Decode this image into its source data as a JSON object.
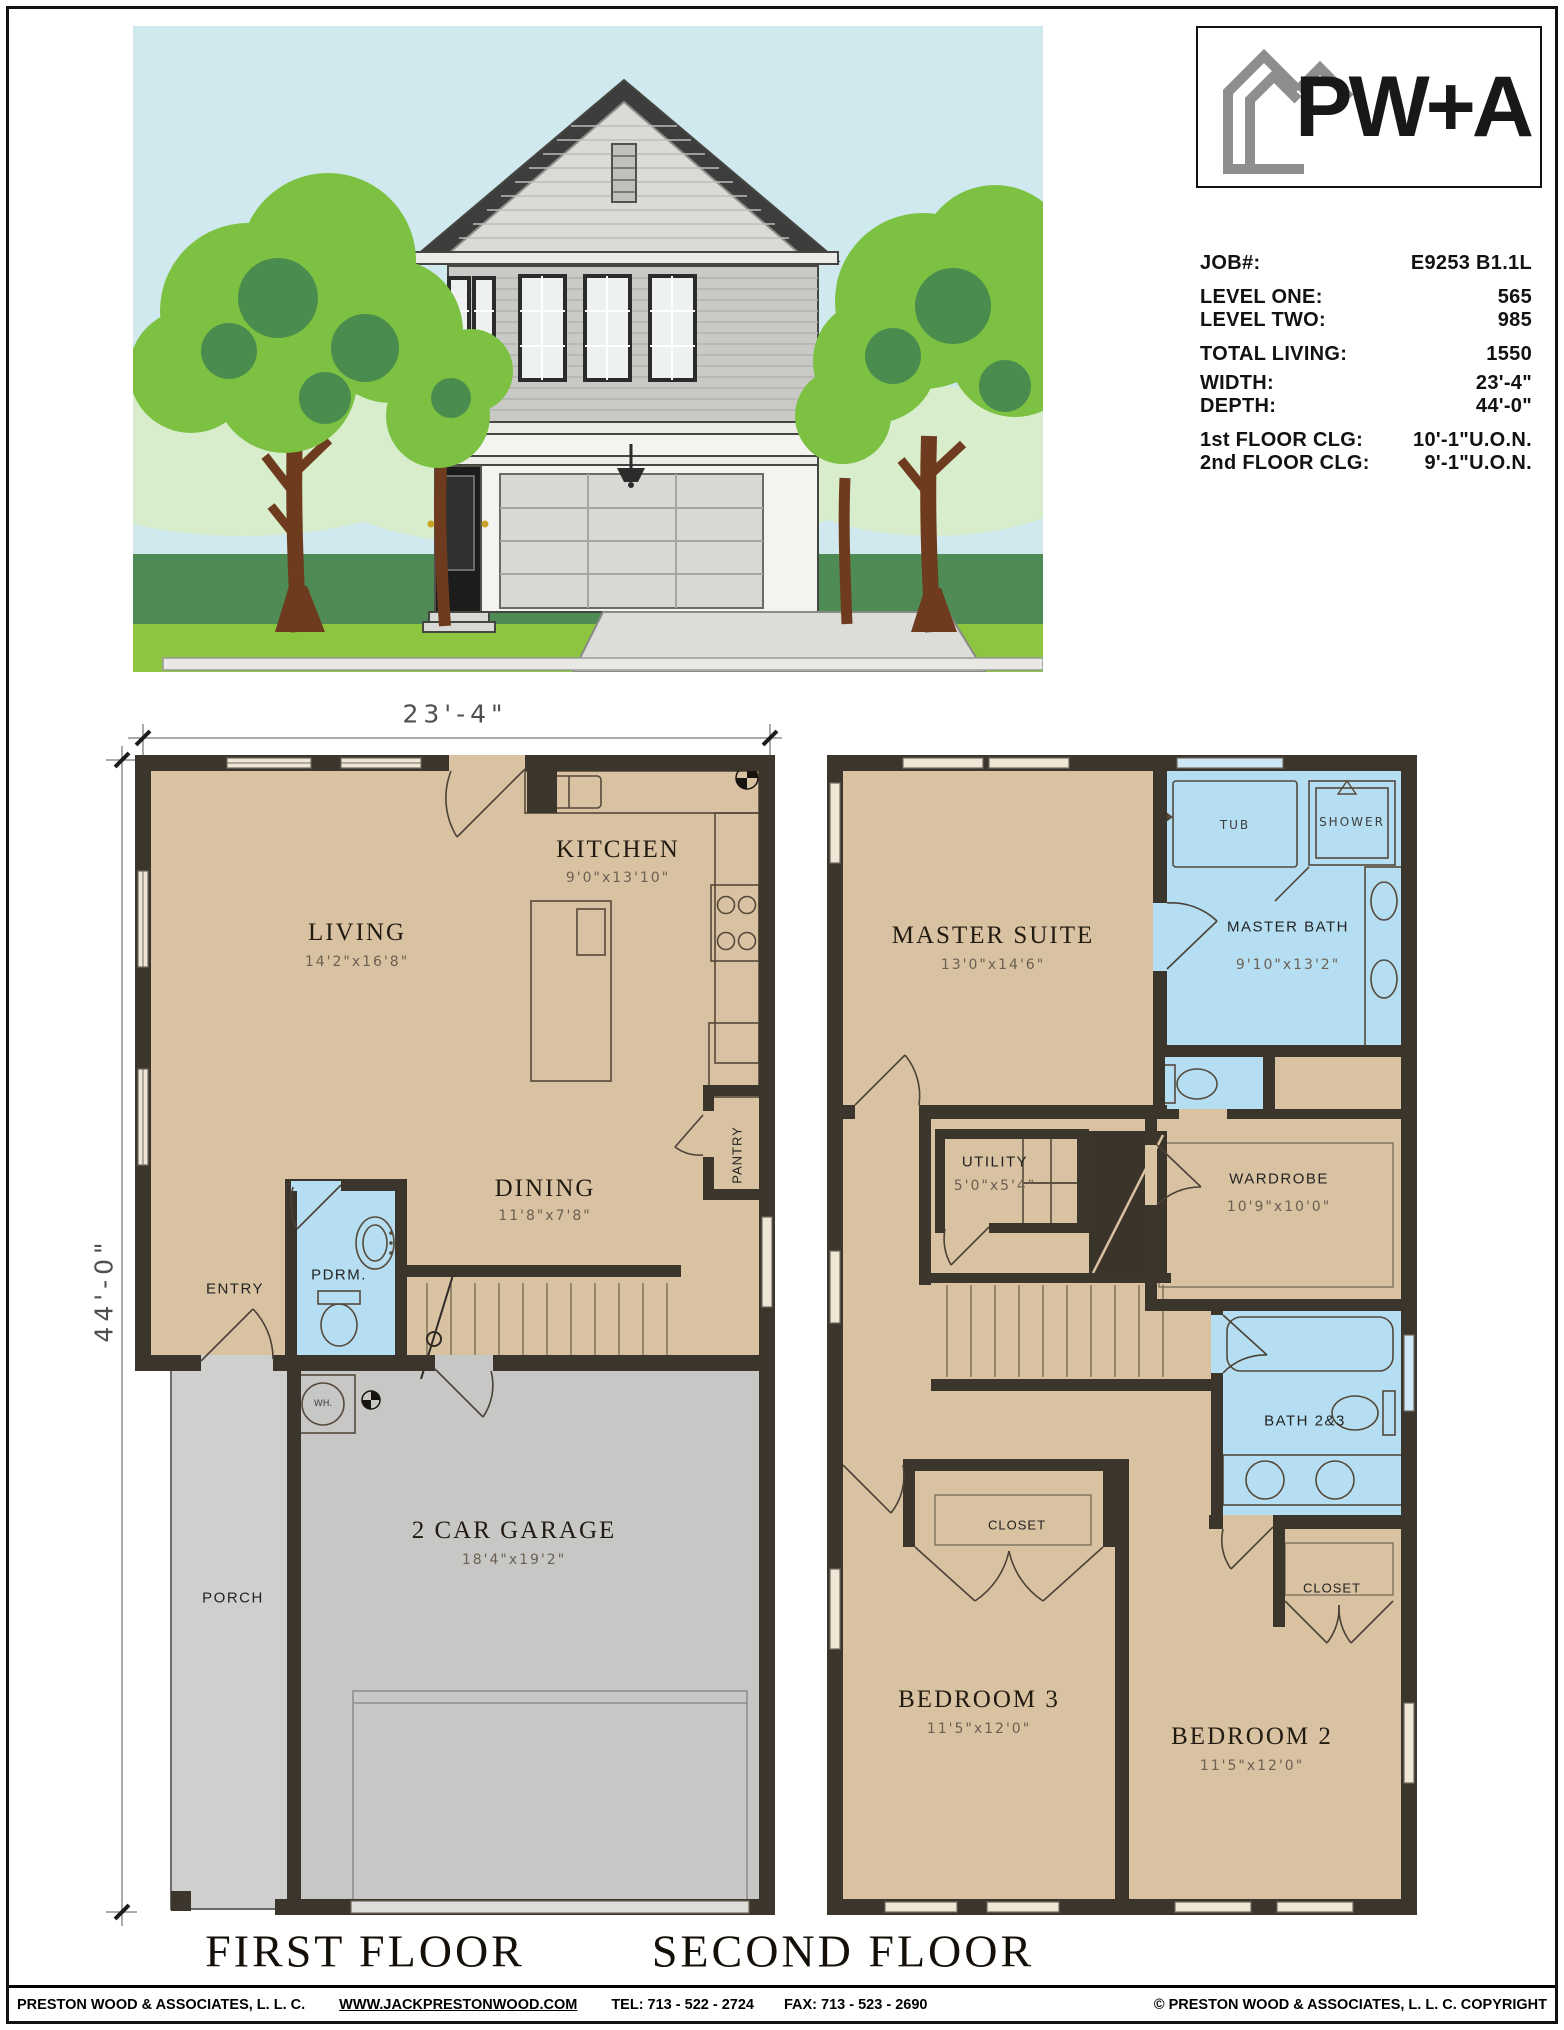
{
  "logo": {
    "text": "PW+A"
  },
  "job": {
    "rows": [
      {
        "label": "JOB#:",
        "value": "E9253 B1.1L"
      },
      {
        "label": "LEVEL ONE:",
        "value": "565"
      },
      {
        "label": "LEVEL TWO:",
        "value": "985"
      },
      {
        "label": "TOTAL LIVING:",
        "value": "1550"
      },
      {
        "label": "WIDTH:",
        "value": "23'-4\""
      },
      {
        "label": "DEPTH:",
        "value": "44'-0\""
      },
      {
        "label": "1st FLOOR CLG:",
        "value": "10'-1\"U.O.N."
      },
      {
        "label": "2nd FLOOR CLG:",
        "value": "9'-1\"U.O.N."
      }
    ]
  },
  "dims": {
    "width": "23'-4\"",
    "depth": "44'-0\""
  },
  "first_floor": {
    "title": "FIRST FLOOR",
    "rooms": {
      "living": {
        "name": "LIVING",
        "dims": "14'2\"x16'8\""
      },
      "kitchen": {
        "name": "KITCHEN",
        "dims": "9'0\"x13'10\""
      },
      "dining": {
        "name": "DINING",
        "dims": "11'8\"x7'8\""
      },
      "entry": {
        "name": "ENTRY"
      },
      "pdrm": {
        "name": "PDRM."
      },
      "pantry": {
        "name": "PANTRY"
      },
      "porch": {
        "name": "PORCH"
      },
      "garage": {
        "name": "2 CAR GARAGE",
        "dims": "18'4\"x19'2\""
      },
      "wh": {
        "name": "WH."
      }
    }
  },
  "second_floor": {
    "title": "SECOND FLOOR",
    "rooms": {
      "master_suite": {
        "name": "MASTER SUITE",
        "dims": "13'0\"x14'6\""
      },
      "master_bath": {
        "name": "MASTER BATH",
        "dims": "9'10\"x13'2\""
      },
      "tub": {
        "name": "TUB"
      },
      "shower": {
        "name": "SHOWER"
      },
      "utility": {
        "name": "UTILITY",
        "dims": "5'0\"x5'4\""
      },
      "wardrobe": {
        "name": "WARDROBE",
        "dims": "10'9\"x10'0\""
      },
      "bath23": {
        "name": "BATH 2&3"
      },
      "closet3": {
        "name": "CLOSET"
      },
      "closet2": {
        "name": "CLOSET"
      },
      "bedroom3": {
        "name": "BEDROOM 3",
        "dims": "11'5\"x12'0\""
      },
      "bedroom2": {
        "name": "BEDROOM 2",
        "dims": "11'5\"x12'0\""
      }
    }
  },
  "footer": {
    "company": "PRESTON WOOD & ASSOCIATES, L. L. C.",
    "website": "WWW.JACKPRESTONWOOD.COM",
    "tel": "TEL:  713 - 522 - 2724",
    "fax": "FAX:  713 - 523 - 2690",
    "copyright": "© PRESTON WOOD & ASSOCIATES, L. L. C.  COPYRIGHT"
  }
}
